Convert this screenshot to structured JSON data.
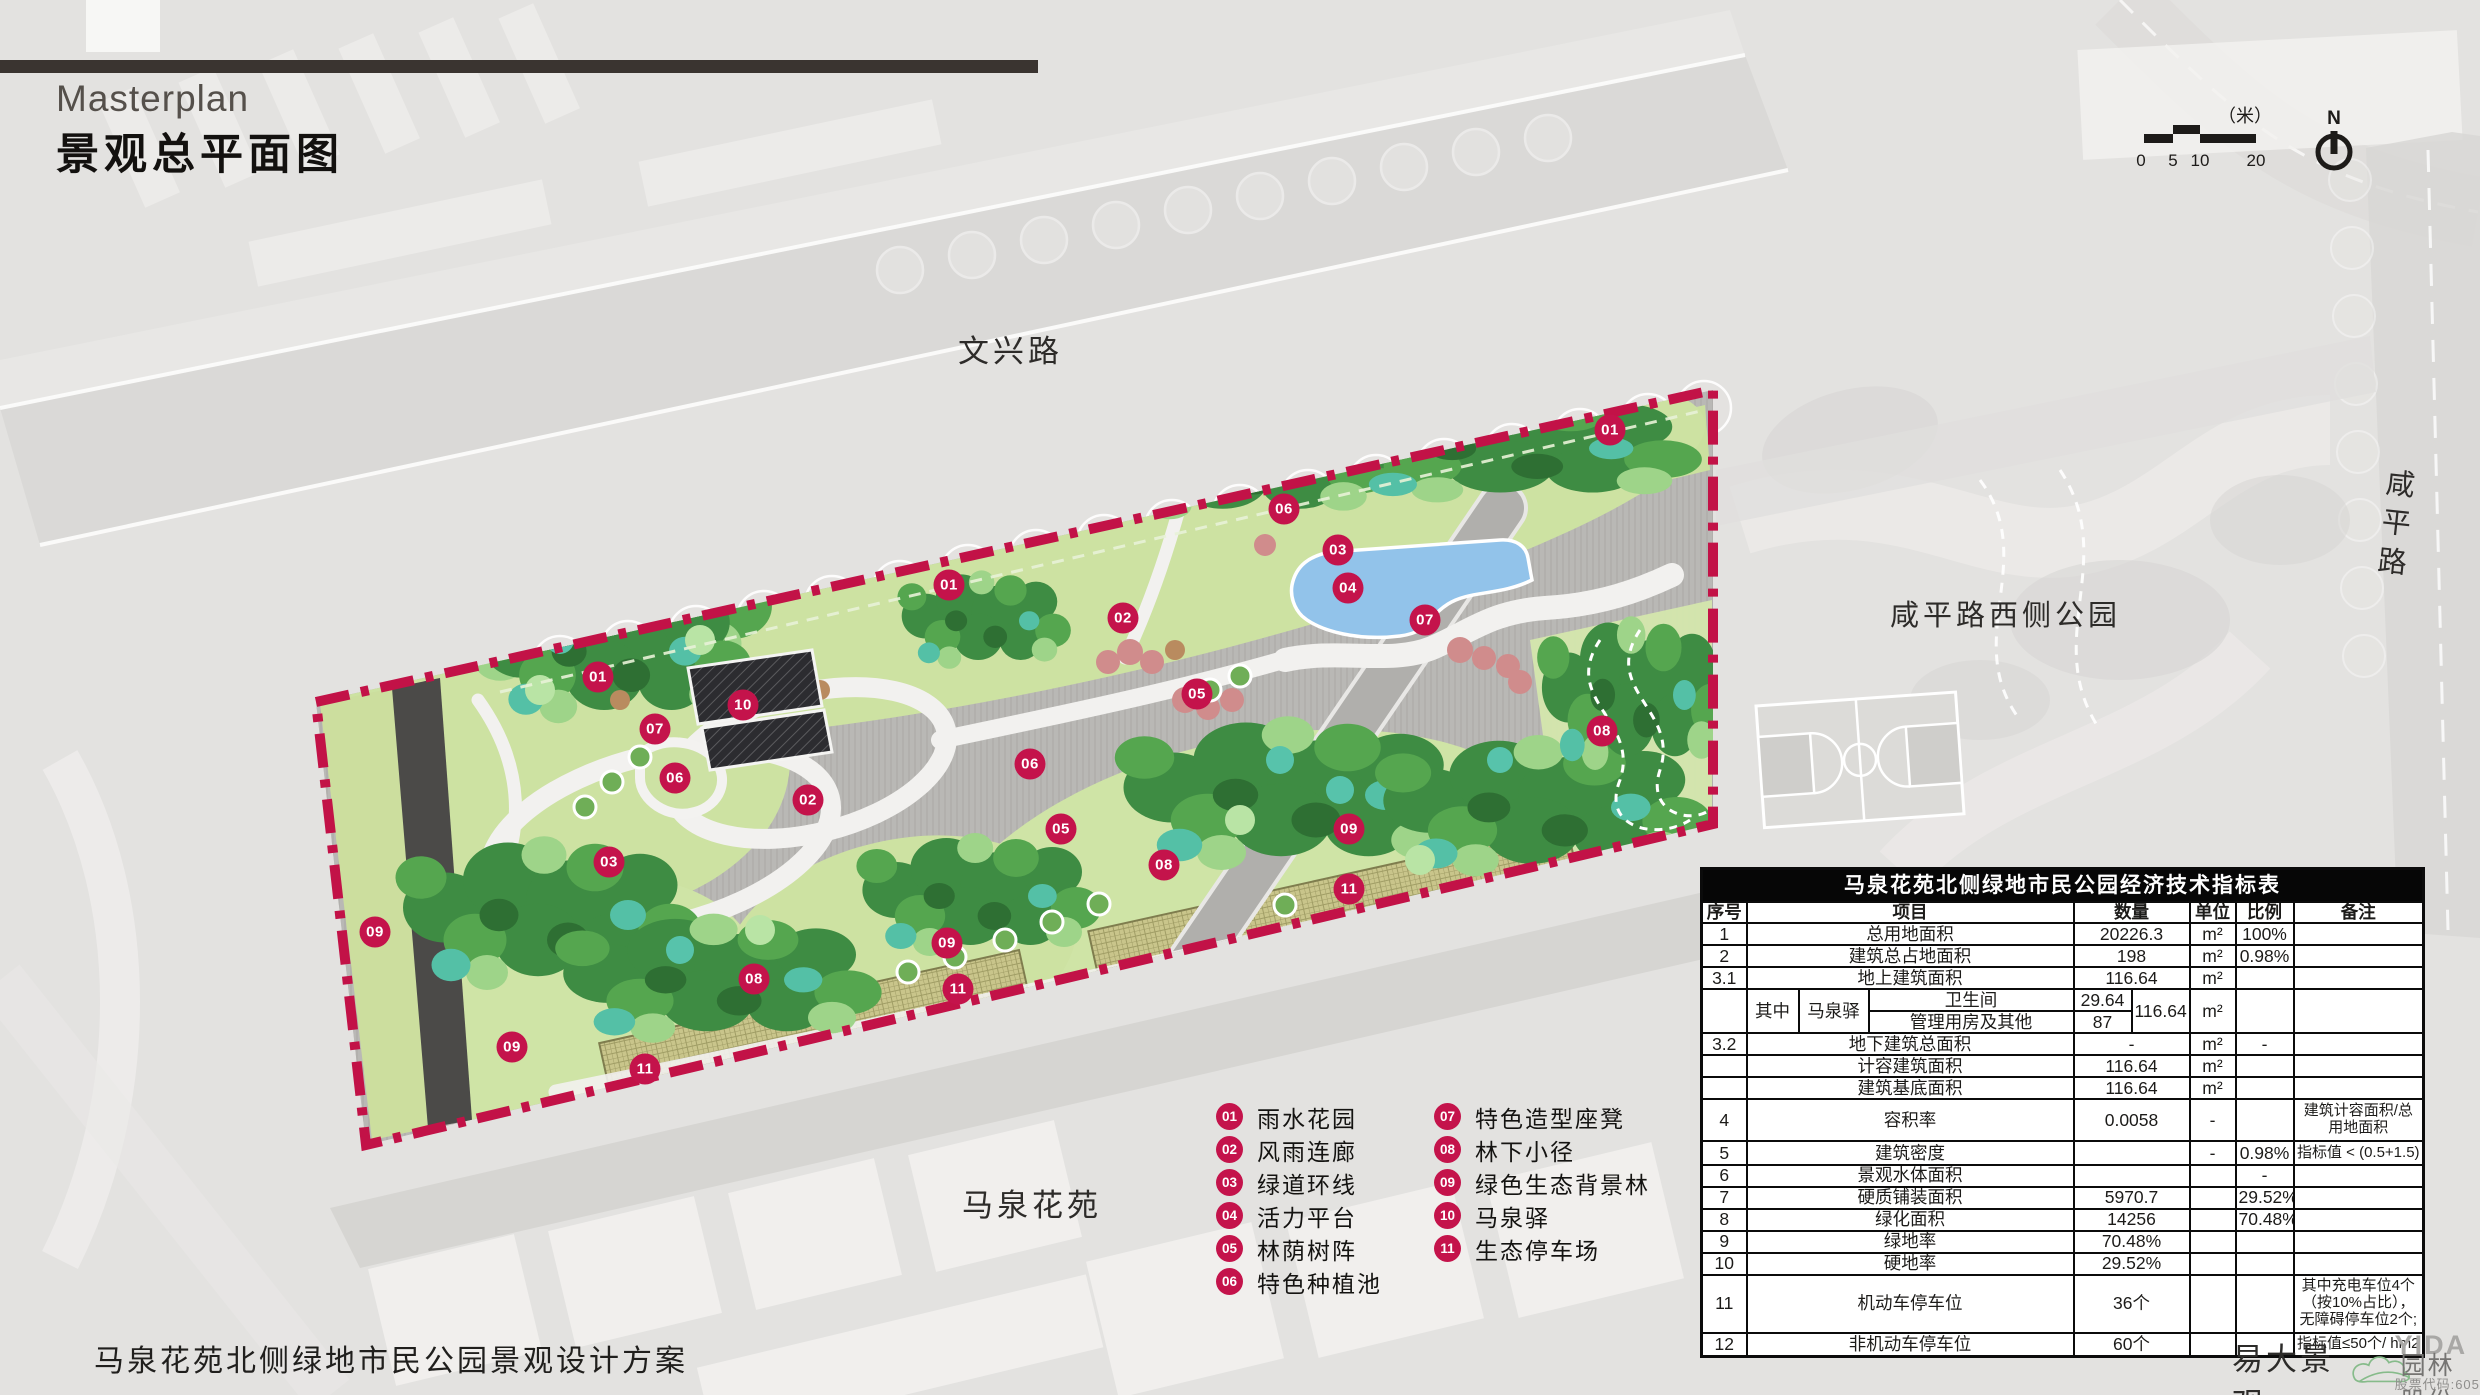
{
  "title": {
    "en": "Masterplan",
    "zh": "景观总平面图"
  },
  "map_labels": {
    "road_top": "文兴路",
    "park_right": "咸平路西侧公园",
    "road_right": "咸平路",
    "residential": "马泉花苑"
  },
  "scalebar": {
    "unit": "（米）",
    "ticks": [
      "0",
      "5",
      "10",
      "20"
    ]
  },
  "north": {
    "label": "N"
  },
  "legend": {
    "columns": [
      [
        {
          "num": "01",
          "label": "雨水花园"
        },
        {
          "num": "02",
          "label": "风雨连廊"
        },
        {
          "num": "03",
          "label": "绿道环线"
        },
        {
          "num": "04",
          "label": "活力平台"
        },
        {
          "num": "05",
          "label": "林荫树阵"
        },
        {
          "num": "06",
          "label": "特色种植池"
        }
      ],
      [
        {
          "num": "07",
          "label": "特色造型座凳"
        },
        {
          "num": "08",
          "label": "林下小径"
        },
        {
          "num": "09",
          "label": "绿色生态背景林"
        },
        {
          "num": "10",
          "label": "马泉驿"
        },
        {
          "num": "11",
          "label": "生态停车场"
        }
      ]
    ]
  },
  "plan": {
    "markers": [
      {
        "n": "01",
        "x": 1610,
        "y": 430
      },
      {
        "n": "06",
        "x": 1284,
        "y": 509
      },
      {
        "n": "03",
        "x": 1338,
        "y": 550
      },
      {
        "n": "04",
        "x": 1348,
        "y": 588
      },
      {
        "n": "01",
        "x": 949,
        "y": 585
      },
      {
        "n": "02",
        "x": 1123,
        "y": 618
      },
      {
        "n": "07",
        "x": 1425,
        "y": 620
      },
      {
        "n": "05",
        "x": 1197,
        "y": 694
      },
      {
        "n": "01",
        "x": 598,
        "y": 677
      },
      {
        "n": "10",
        "x": 743,
        "y": 705
      },
      {
        "n": "07",
        "x": 655,
        "y": 729
      },
      {
        "n": "08",
        "x": 1602,
        "y": 731
      },
      {
        "n": "06",
        "x": 675,
        "y": 778
      },
      {
        "n": "06",
        "x": 1030,
        "y": 764
      },
      {
        "n": "02",
        "x": 808,
        "y": 800
      },
      {
        "n": "05",
        "x": 1061,
        "y": 829
      },
      {
        "n": "09",
        "x": 1349,
        "y": 829
      },
      {
        "n": "03",
        "x": 609,
        "y": 862
      },
      {
        "n": "08",
        "x": 1164,
        "y": 865
      },
      {
        "n": "11",
        "x": 1349,
        "y": 889
      },
      {
        "n": "09",
        "x": 375,
        "y": 932
      },
      {
        "n": "09",
        "x": 947,
        "y": 943
      },
      {
        "n": "08",
        "x": 754,
        "y": 979
      },
      {
        "n": "11",
        "x": 958,
        "y": 989
      },
      {
        "n": "09",
        "x": 512,
        "y": 1047
      },
      {
        "n": "11",
        "x": 645,
        "y": 1069
      }
    ]
  },
  "table": {
    "title": "马泉花苑北侧绿地市民公园经济技术指标表",
    "headers": [
      "序号",
      "项目",
      "数量",
      "单位",
      "比例",
      "备注"
    ],
    "rows_top": [
      {
        "no": "1",
        "item": "总用地面积",
        "qty": "20226.3",
        "unit": "m²",
        "ratio": "100%",
        "note": ""
      },
      {
        "no": "2",
        "item": "建筑总占地面积",
        "qty": "198",
        "unit": "m²",
        "ratio": "0.98%",
        "note": ""
      },
      {
        "no": "3.1",
        "item": "地上建筑面积",
        "qty": "116.64",
        "unit": "m²",
        "ratio": "",
        "note": ""
      }
    ],
    "sub_row": {
      "label": "其中",
      "group": "马泉驿",
      "a_item": "卫生间",
      "a_qty": "29.64",
      "b_item": "管理用房及其他",
      "b_qty": "87",
      "total": "116.64",
      "unit": "m²"
    },
    "rows_bottom": [
      {
        "no": "3.2",
        "item": "地下建筑总面积",
        "qty": "-",
        "unit": "m²",
        "ratio": "-",
        "note": ""
      },
      {
        "no": "",
        "item": "计容建筑面积",
        "qty": "116.64",
        "unit": "m²",
        "ratio": "",
        "note": ""
      },
      {
        "no": "",
        "item": "建筑基底面积",
        "qty": "116.64",
        "unit": "m²",
        "ratio": "",
        "note": ""
      },
      {
        "no": "4",
        "item": "容积率",
        "qty": "0.0058",
        "unit": "-",
        "ratio": "",
        "note": "建筑计容面积/总用地面积"
      },
      {
        "no": "5",
        "item": "建筑密度",
        "qty": "",
        "unit": "-",
        "ratio": "0.98%",
        "note": "指标值 < (0.5+1.5)"
      },
      {
        "no": "6",
        "item": "景观水体面积",
        "qty": "",
        "unit": "",
        "ratio": "-",
        "note": ""
      },
      {
        "no": "7",
        "item": "硬质铺装面积",
        "qty": "5970.7",
        "unit": "",
        "ratio": "29.52%",
        "note": ""
      },
      {
        "no": "8",
        "item": "绿化面积",
        "qty": "14256",
        "unit": "",
        "ratio": "70.48%",
        "note": ""
      },
      {
        "no": "9",
        "item": "绿地率",
        "qty": "70.48%",
        "unit": "",
        "ratio": "",
        "note": ""
      },
      {
        "no": "10",
        "item": "硬地率",
        "qty": "29.52%",
        "unit": "",
        "ratio": "",
        "note": ""
      },
      {
        "no": "11",
        "item": "机动车停车位",
        "qty": "36个",
        "unit": "",
        "ratio": "",
        "note": "其中充电车位4个（按10%占比），无障碍停车位2个;"
      },
      {
        "no": "12",
        "item": "非机动车停车位",
        "qty": "60个",
        "unit": "",
        "ratio": "",
        "note": "指标值≤50个/ hm2"
      }
    ]
  },
  "footer": {
    "project": "马泉花苑北侧绿地市民公园景观设计方案"
  },
  "logo": {
    "name": "易大景观",
    "brand": "YIDA",
    "brand_sub": "园林股份",
    "stock": "股票代码:605303"
  },
  "colors": {
    "accent_crimson": "#C4134B",
    "pond_blue": "#92C3EA",
    "paving_gray": "#B9B8B5",
    "lawn_green": "#CDE2A2",
    "tree_dark": "#3E8C43",
    "tree_mid": "#55A64F",
    "tree_light": "#9ED489",
    "tree_teal": "#54C0A6",
    "shrub_pink": "#D08C8C",
    "parking_khaki": "#C9C58B",
    "title_bar": "#3A3430",
    "table_header_bg": "#060606"
  }
}
